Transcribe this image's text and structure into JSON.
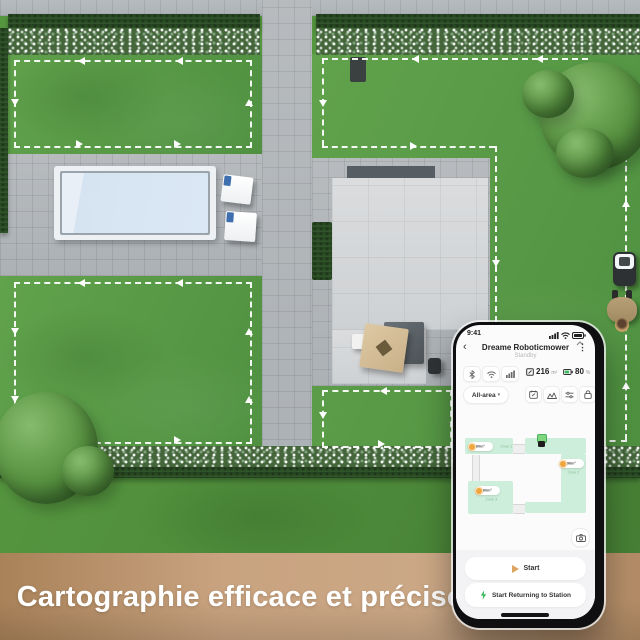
{
  "caption": {
    "text": "Cartographie efficace et précise"
  },
  "phone": {
    "status": {
      "time": "9:41"
    },
    "header": {
      "back": "‹",
      "title": "Dreame Roboticmower",
      "subtitle": "Standby",
      "menu": "⋮"
    },
    "stats": {
      "area_value": "216",
      "area_unit": "m²",
      "battery_value": "80",
      "battery_unit": "%"
    },
    "toolbar": {
      "area_selector": "All-area",
      "caret": "▾"
    },
    "map": {
      "zones": [
        {
          "name": "Zone 1",
          "area": "60m²"
        },
        {
          "name": "Zone 2",
          "area": "96m²"
        },
        {
          "name": "Zone 3",
          "area": "60m²"
        }
      ]
    },
    "actions": {
      "start": "Start",
      "return_to_station": "Start Returning to Station"
    }
  },
  "icons": {
    "status_bar": [
      "signal-icon",
      "wifi-icon",
      "battery-icon"
    ],
    "connectivity": [
      "bluetooth-icon",
      "wifi-icon",
      "cellular-icon"
    ],
    "stats": [
      "area-icon",
      "battery-icon"
    ],
    "toolbar": [
      "calendar-icon",
      "zones-icon",
      "sliders-icon",
      "lock-icon"
    ],
    "map": [
      "dock-station-icon",
      "camera-icon"
    ],
    "actions": [
      "play-icon",
      "flash-icon"
    ]
  },
  "colors": {
    "zone_fill": "#cdeeda",
    "accent_orange": "#efa63e",
    "accent_green": "#3cb95f",
    "band_brown": "#b98f66"
  }
}
